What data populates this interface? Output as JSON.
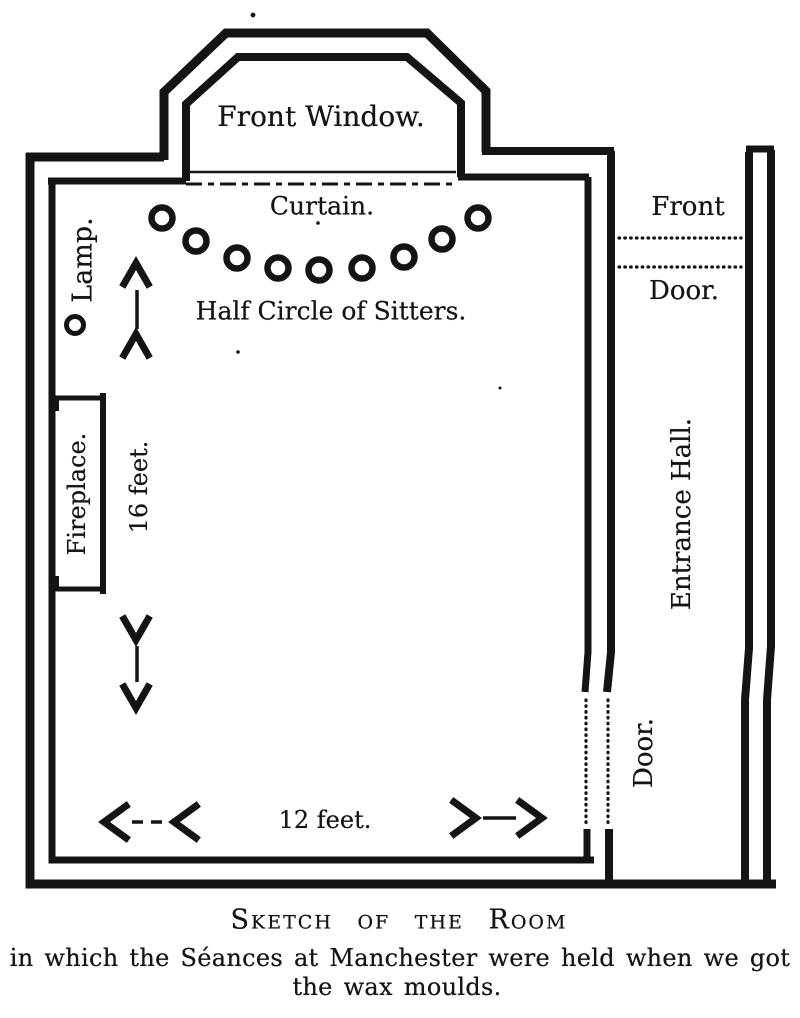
{
  "colors": {
    "ink": "#141414",
    "paper": "#ffffff"
  },
  "plan": {
    "front_window_label": "Front Window.",
    "curtain_label": "Curtain.",
    "sitters_label": "Half Circle of Sitters.",
    "lamp_label": "Lamp.",
    "fireplace_label": "Fireplace.",
    "room_length_label": "16 feet.",
    "room_width_label": "12 feet.",
    "front_door_label_top": "Front",
    "front_door_label_bottom": "Door.",
    "entrance_hall_label": "Entrance Hall.",
    "room_door_label": "Door.",
    "sitters": {
      "count": 9,
      "radius": 10.5,
      "positions": [
        [
          162,
          218
        ],
        [
          196,
          241
        ],
        [
          237,
          258
        ],
        [
          278,
          268
        ],
        [
          319,
          270
        ],
        [
          362,
          268
        ],
        [
          404,
          257
        ],
        [
          442,
          239
        ],
        [
          478,
          218
        ]
      ]
    },
    "lamp": {
      "position": [
        75,
        325
      ],
      "radius": 8.5
    }
  },
  "caption": {
    "title": "Sketch of the Room",
    "line1": "in which the Séances at Manchester were held when we got",
    "line2": "the wax moulds."
  }
}
